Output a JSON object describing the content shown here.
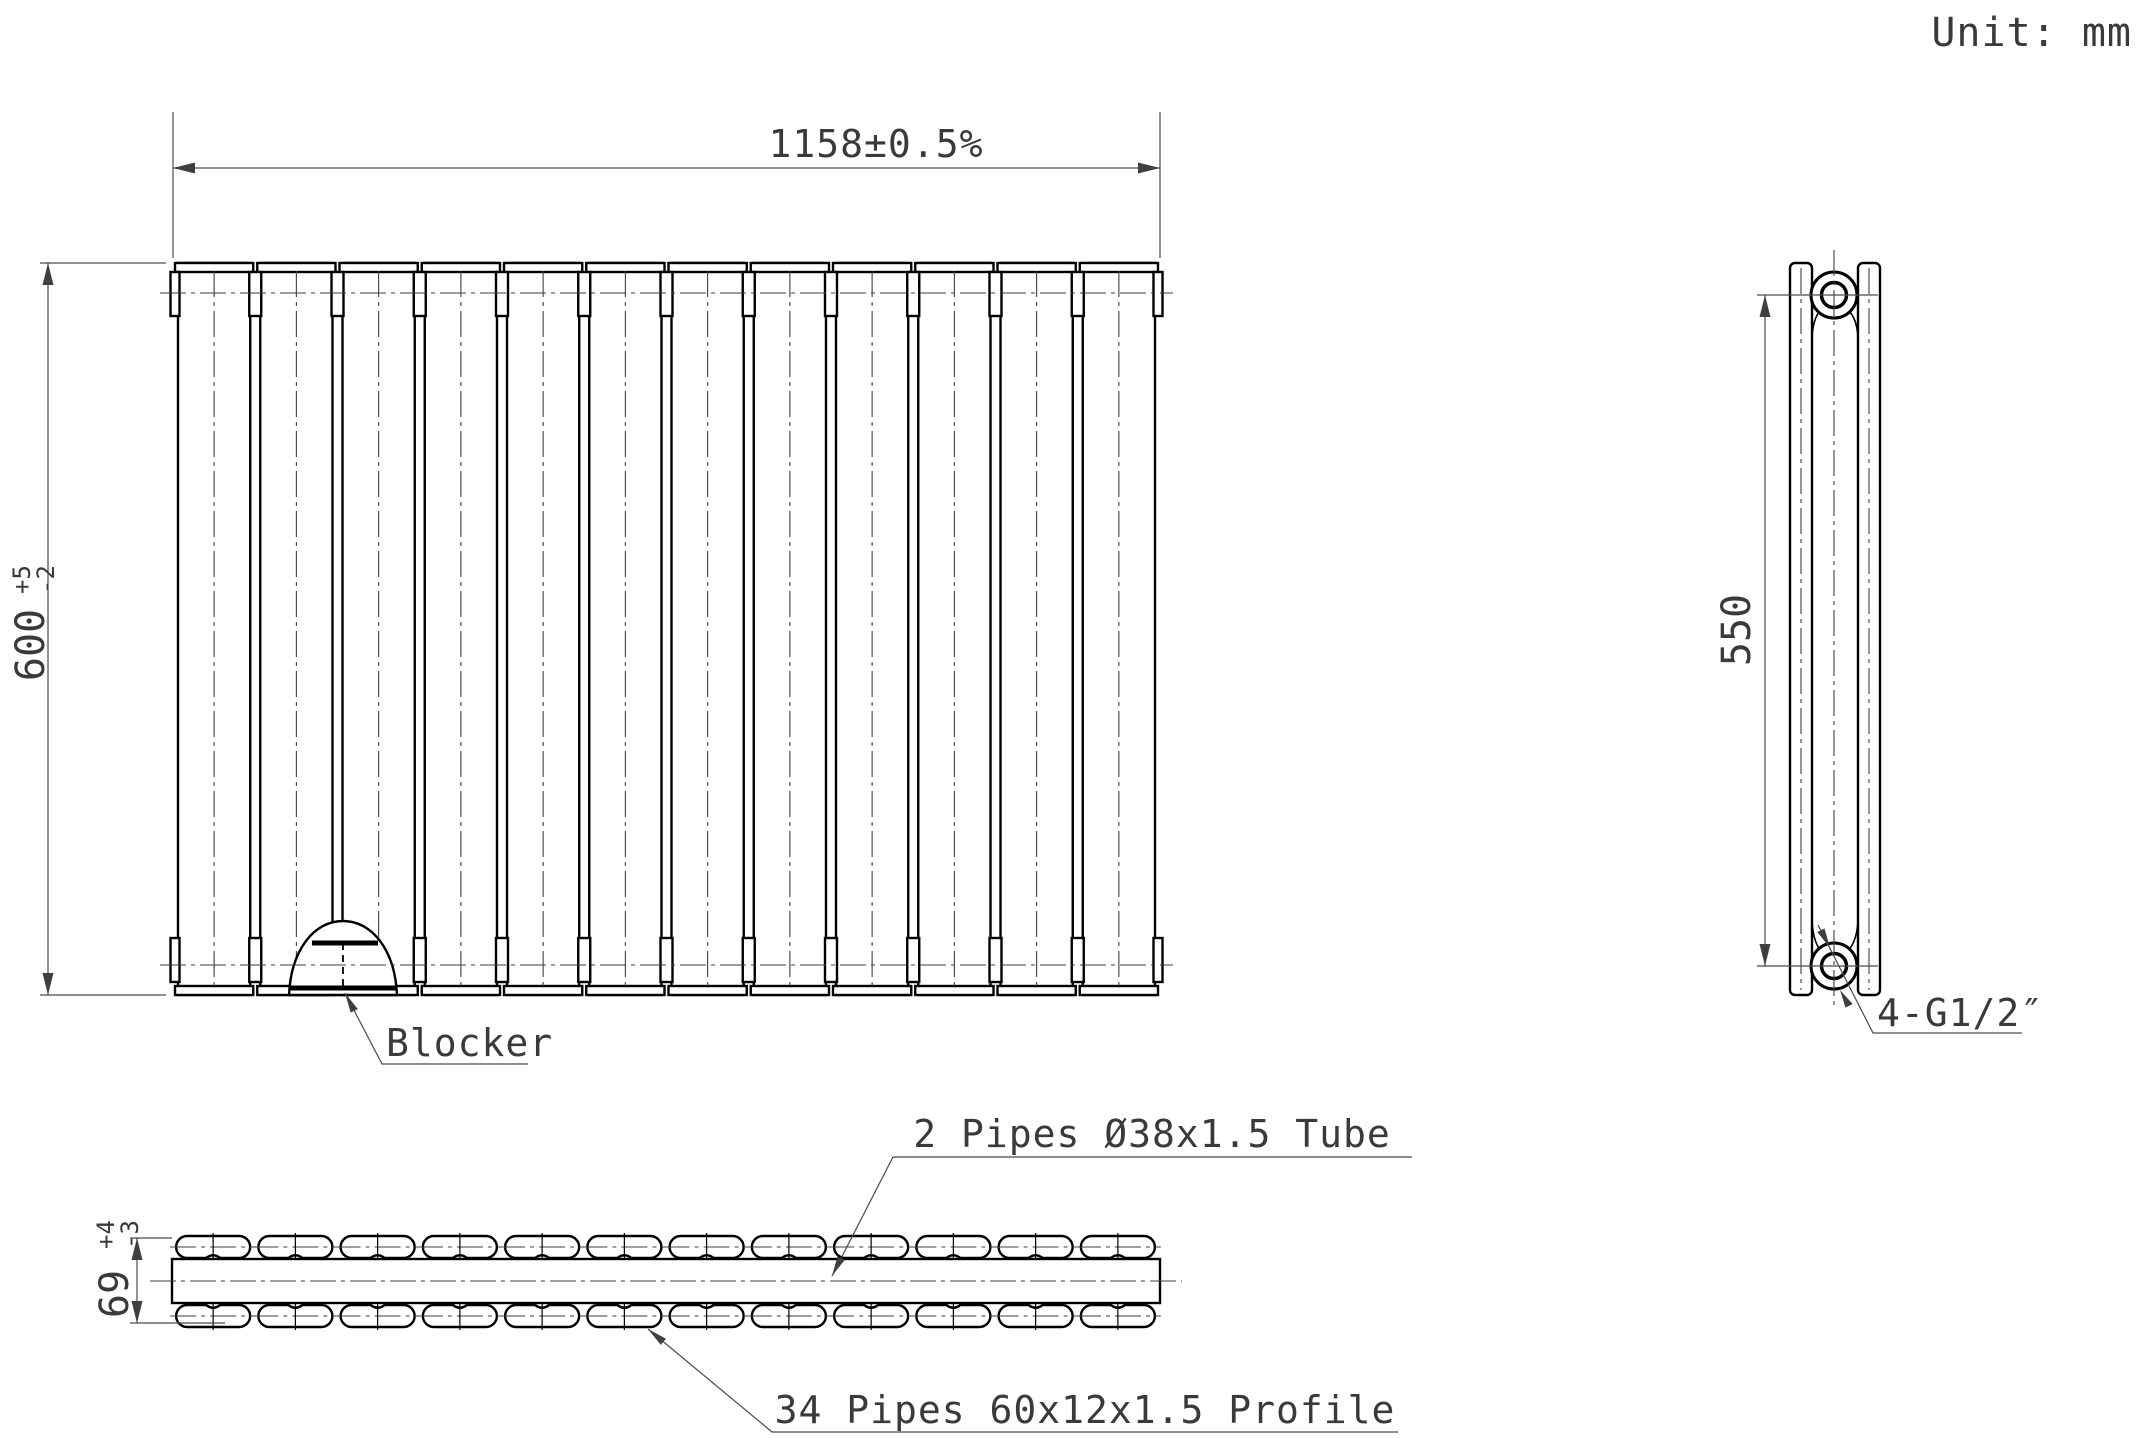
{
  "meta": {
    "unit_label": "Unit: mm",
    "drawing_type": "radiator technical drawing"
  },
  "front_view": {
    "width_dim": "1158±0.5%",
    "height_dim": {
      "value": "600",
      "tol_plus": "+5",
      "tol_minus": "-2"
    },
    "blocker_label": "Blocker",
    "panel_count": 12
  },
  "side_view": {
    "height_dim": "550",
    "ports_label": "4-G1/2″"
  },
  "section_view": {
    "depth_dim": {
      "value": "69",
      "tol_plus": "+4",
      "tol_minus": "-3"
    },
    "tube_label": "2 Pipes Ø38x1.5 Tube",
    "profile_label": "34 Pipes 60x12x1.5 Profile",
    "profile_columns": 12
  },
  "colors": {
    "outline": "#000000",
    "thin_line": "#4a4a4a",
    "text": "#3a3a3a",
    "background": "#ffffff"
  }
}
